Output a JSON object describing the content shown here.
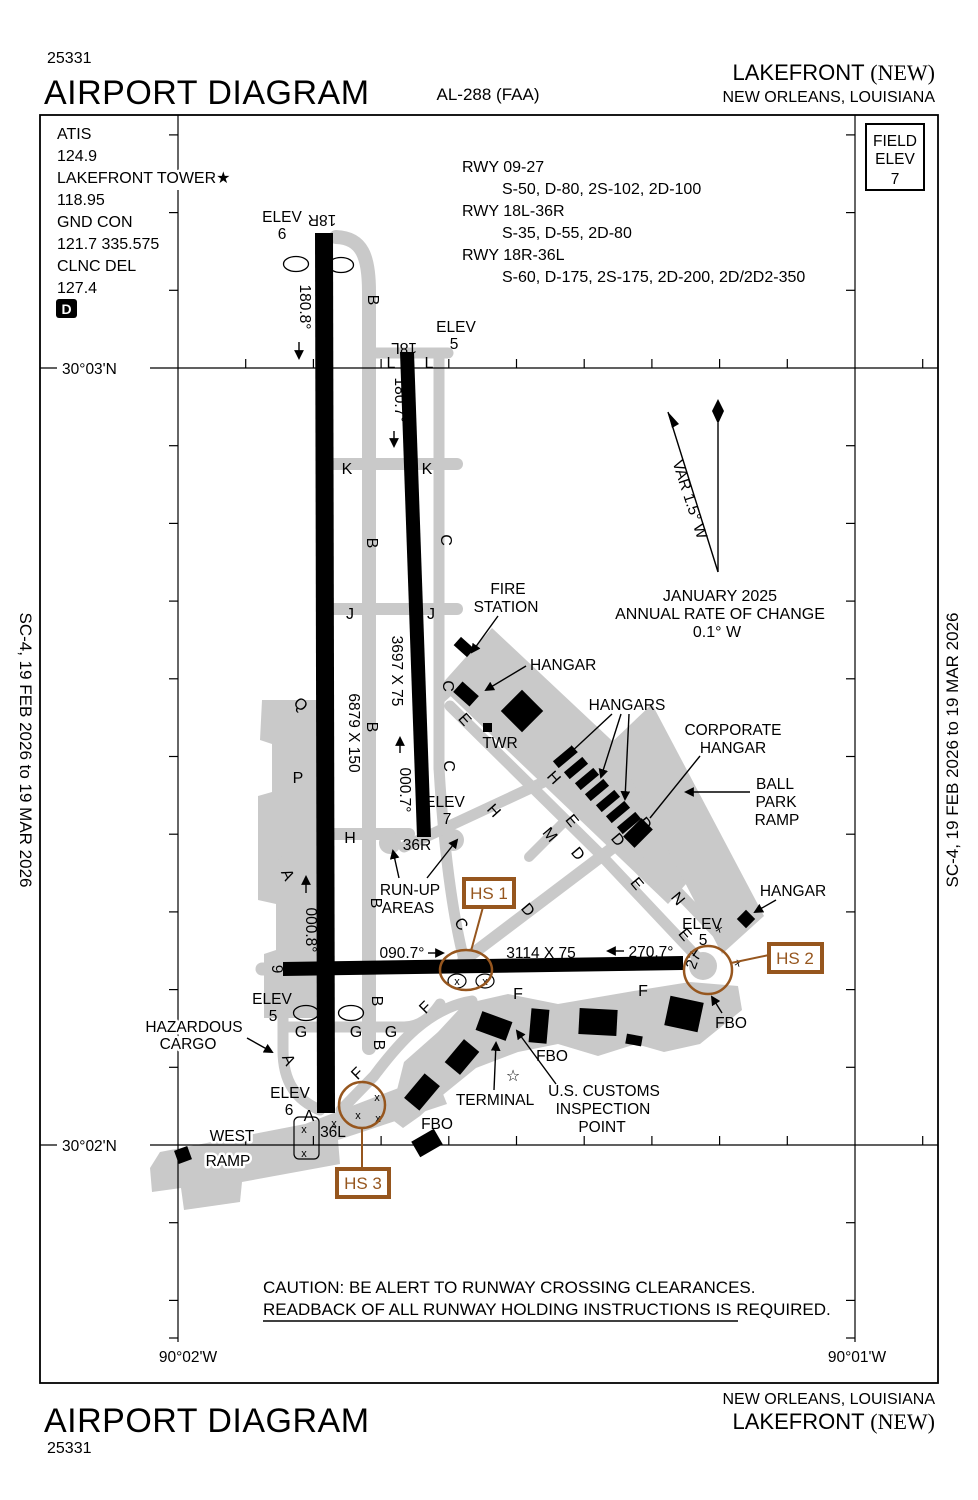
{
  "colors": {
    "hotspot": "#96561e",
    "pavement": "#c9c9c9",
    "ink": "#000000"
  },
  "header": {
    "chart_num": "25331",
    "title": "AIRPORT DIAGRAM",
    "chart_code": "AL-288 (FAA)",
    "airport": "LAKEFRONT ",
    "airport_suffix": "(NEW)",
    "city": "NEW ORLEANS,  LOUISIANA"
  },
  "footer": {
    "title": "AIRPORT DIAGRAM",
    "chart_num": "25331",
    "city": "NEW ORLEANS,  LOUISIANA",
    "airport": "LAKEFRONT ",
    "airport_suffix": "(NEW)"
  },
  "margins": {
    "effective_left": "SC-4,  19 FEB 2026  to  19 MAR 2026",
    "effective_right": "SC-4,  19 FEB 2026  to  19 MAR 2026"
  },
  "comm": {
    "atis_label": "ATIS",
    "atis_freq": "124.9",
    "twr_label": "LAKEFRONT TOWER",
    "twr_star": "★",
    "twr_freq": "118.95",
    "gnd_label": "GND CON",
    "gnd_freq": "121.7 335.575",
    "clnc_label": "CLNC DEL",
    "clnc_freq": "127.4",
    "notam_d": "D"
  },
  "field_elev": {
    "line1": "FIELD",
    "line2": "ELEV",
    "value": "7"
  },
  "rwy_data": [
    {
      "name": "RWY 09-27",
      "spec": "S-50, D-80, 2S-102, 2D-100"
    },
    {
      "name": "RWY 18L-36R",
      "spec": "S-35, D-55, 2D-80"
    },
    {
      "name": "RWY 18R-36L",
      "spec": "S-60, D-175, 2S-175, 2D-200, 2D/2D2-350"
    }
  ],
  "graticule": {
    "lat_top": "30°03'N",
    "lat_bottom": "30°02'N",
    "lon_left": "90°02'W",
    "lon_right": "90°01'W"
  },
  "compass": {
    "variation": "VAR 1.5° W",
    "date": "JANUARY 2025",
    "rate_label": "ANNUAL RATE OF CHANGE",
    "rate_value": "0.1° W"
  },
  "runways": {
    "r18r": {
      "id": "18R",
      "elev_label": "ELEV",
      "elev": "6",
      "heading": "180.8°",
      "dims": "6879 X 150"
    },
    "r36l": {
      "id": "36L",
      "elev_label": "ELEV",
      "elev": "6",
      "heading": "000.8°"
    },
    "r18l": {
      "id": "18L",
      "elev_label": "ELEV",
      "elev": "5",
      "heading": "180.7°",
      "dims": "3697 X 75"
    },
    "r36r": {
      "id": "36R",
      "elev_label": "ELEV",
      "elev": "7",
      "heading": "000.7°"
    },
    "r09": {
      "id": "9",
      "elev_label": "ELEV",
      "elev": "5",
      "heading": "090.7°",
      "dims": "3114 X 75"
    },
    "r27": {
      "id": "27",
      "elev_label": "ELEV",
      "elev": "5",
      "heading": "270.7°"
    }
  },
  "taxiways": [
    "B",
    "K",
    "K",
    "B",
    "C",
    "J",
    "J",
    "C",
    "E",
    "C",
    "Q",
    "P",
    "B",
    "H",
    "H",
    "H",
    "A",
    "B",
    "C",
    "D",
    "M",
    "E",
    "D",
    "D",
    "D",
    "E",
    "N",
    "E",
    "F",
    "F",
    "F",
    "F",
    "G",
    "G",
    "G",
    "B",
    "B",
    "A",
    "A",
    "L",
    "L"
  ],
  "features": {
    "fire1": "FIRE",
    "fire2": "STATION",
    "hangar_top": "HANGAR",
    "hangars": "HANGARS",
    "corp1": "CORPORATE",
    "corp2": "HANGAR",
    "ball1": "BALL",
    "ball2": "PARK",
    "ball3": "RAMP",
    "twr": "TWR",
    "hangar_e": "HANGAR",
    "runup1": "RUN-UP",
    "runup2": "AREAS",
    "haz1": "HAZARDOUS",
    "haz2": "CARGO",
    "west1": "WEST",
    "west2": "RAMP",
    "terminal": "TERMINAL",
    "customs1": "U.S. CUSTOMS",
    "customs2": "INSPECTION",
    "customs3": "POINT",
    "fbo_mid": "FBO",
    "fbo_sw": "FBO",
    "fbo_e": "FBO",
    "xmark": "x",
    "star": "☆"
  },
  "hotspots": {
    "hs1": "HS 1",
    "hs2": "HS 2",
    "hs3": "HS 3"
  },
  "caution": {
    "line1": "CAUTION: BE ALERT TO RUNWAY CROSSING CLEARANCES.",
    "line2": "READBACK OF  ALL RUNWAY HOLDING INSTRUCTIONS IS REQUIRED."
  }
}
